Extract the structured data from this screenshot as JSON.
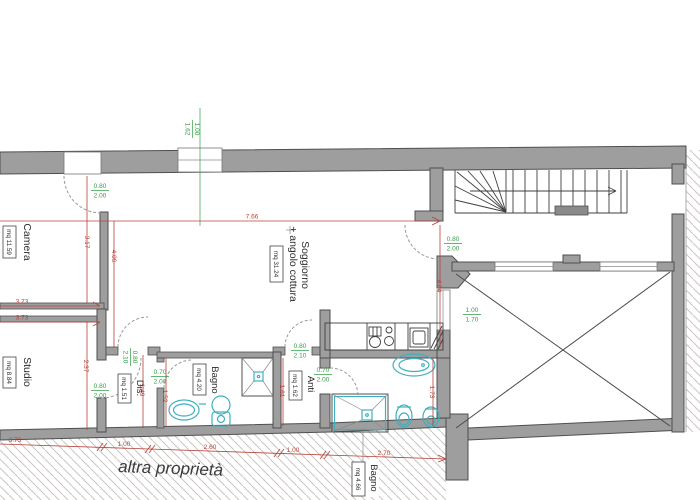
{
  "drawing": {
    "other_property_label": "altra proprietà",
    "rooms": {
      "camera": {
        "name": "Camera",
        "area": "mq 11.59"
      },
      "studio": {
        "name": "Studio",
        "area": "mq 8.84"
      },
      "dis": {
        "name": "Dis.",
        "area": "mq 1.51"
      },
      "bagno1": {
        "name": "Bagno",
        "area": "mq 4.20"
      },
      "anti": {
        "name": "Anti",
        "area": "mq 1.62"
      },
      "soggiorno": {
        "name": "Soggiorno",
        "name2": "+ angolo cottura",
        "area": "mq 31.24"
      },
      "bagno2": {
        "name": "Bagno",
        "area": "mq 4.66"
      }
    },
    "dims_red": {
      "top": "7.66",
      "camera_h": "3.17",
      "sogg_left": "4.09",
      "camera_w1": "3.73",
      "camera_w2": "3.73",
      "studio_h": "2.37",
      "dis_h": "1.49",
      "bagno1_h": "1.52",
      "anti_h": "1.61",
      "entry_h": "4.04",
      "bagno2_h": "1.73",
      "bot1": "3.73",
      "bot2": "1.00",
      "bot3": "2.60",
      "bot4": "1.00",
      "bot5": "2.70"
    },
    "openings_green": {
      "camera_door_w": "0.80",
      "camera_door_h": "2.00",
      "window_top_w": "1.00",
      "window_top_h": "1.62",
      "dis_door_w": "0.80",
      "dis_door_h": "2.10",
      "studio_door_w": "0.80",
      "studio_door_h": "2.00",
      "bagno1_door_w": "0.70",
      "bagno1_door_h": "2.00",
      "anti_door_w": "0.80",
      "anti_door_h": "2.10",
      "bagno2_door_w": "0.70",
      "bagno2_door_h": "2.00",
      "entry_door_w": "0.80",
      "entry_door_h": "2.00",
      "court_window_w": "1.00",
      "court_window_h": "1.70"
    },
    "colors": {
      "wall_gray": "#9e9e9e",
      "dim_red": "#b5423a",
      "opening_green": "#2f9e44",
      "fixture_teal": "#3fb0bd",
      "hatch_gray": "#c9c5c2",
      "background": "#ffffff"
    }
  }
}
